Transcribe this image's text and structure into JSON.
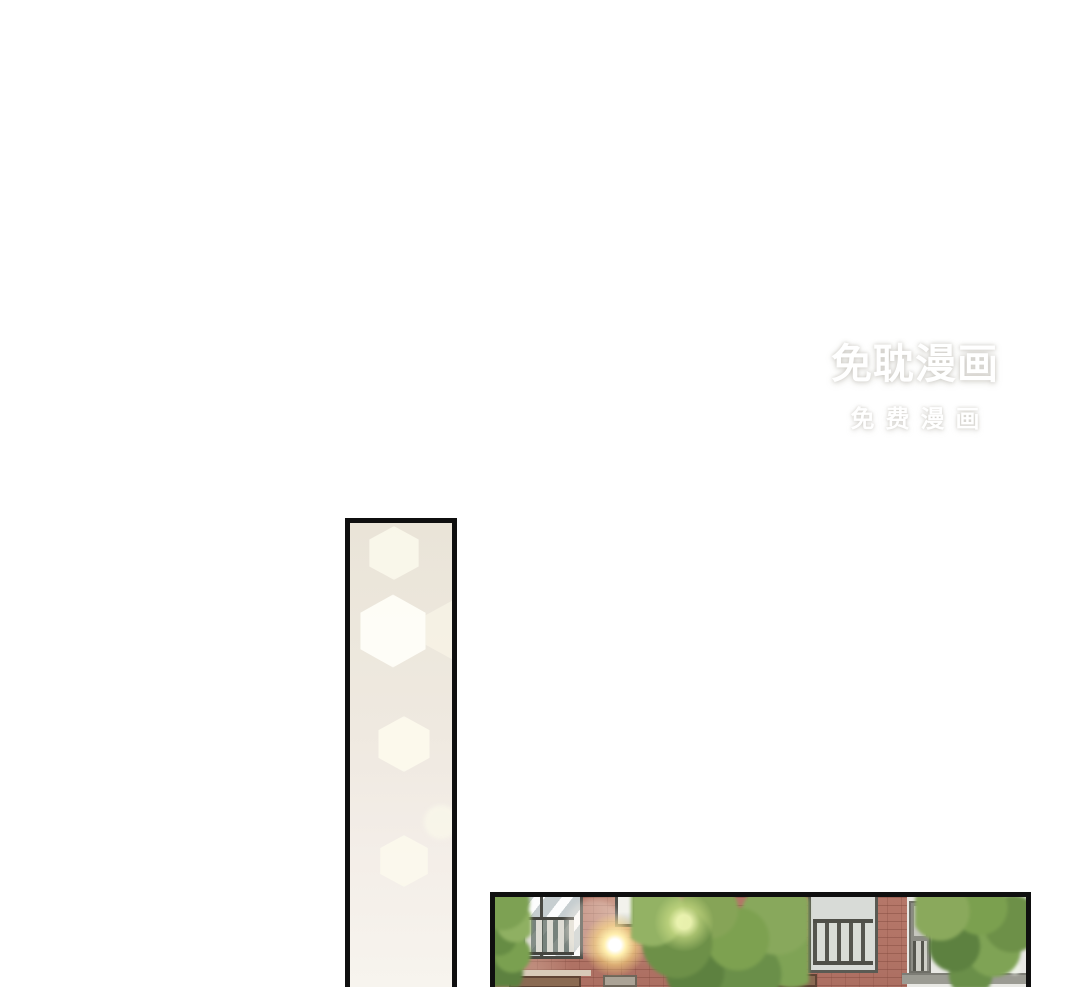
{
  "page": {
    "width": 1080,
    "height": 987,
    "background_color": "#ffffff",
    "content_type": "webtoon comic page"
  },
  "watermark": {
    "line1": "免耽漫画",
    "line2": "免费漫画",
    "text_color": "#ffffff",
    "glow_color": "#bab7af"
  },
  "panels": [
    {
      "name": "tall-blank-panel",
      "alt": "Tall narrow vertical comic panel with warm cream background and soft hexagonal bokeh light spots, cut off at the page bottom",
      "border_color": "#0f0f0f",
      "background_top_color": "#eae4d8",
      "background_bottom_color": "#f7f4ee",
      "bokeh_color": "#fffef8"
    },
    {
      "name": "building-panel",
      "alt": "Wide comic panel showing a red brick apartment building with balcony windows and railings, green leafy trees and a bright sun flare, cut off at the page bottom",
      "border_color": "#0f0f0f",
      "brick_color": "#b37467",
      "mortar_color": "#804839",
      "wall_light_color": "#e8e8e4",
      "window_frame_color": "#4a4a44",
      "glass_color": "#dfe3e4",
      "railing_bar_color": "#dddcd4",
      "tree_green_dark": "#55793e",
      "tree_green_mid": "#7d9c50",
      "tree_green_light": "#a3bd6f",
      "sun_flare_color": "#ffefae",
      "ledge_color": "#9b9b93"
    }
  ]
}
